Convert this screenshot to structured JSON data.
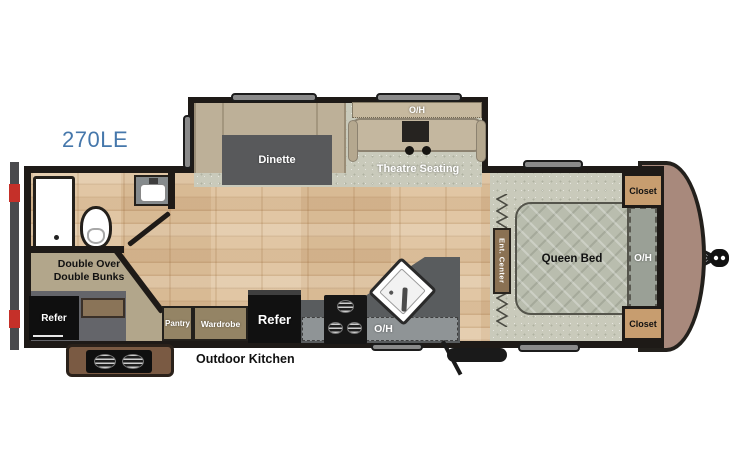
{
  "model": "270LE",
  "colors": {
    "model_text": "#4577ab",
    "wall": "#1e1a17",
    "wood_floor": "#dec19c",
    "carpet": "#c9cabb",
    "bench_tan": "#bdb098",
    "seat_tan": "#c4b79f",
    "table_gray": "#58595b",
    "counter_gray": "#595c5e",
    "overhead_gray": "#8f9496",
    "cabinet_brown": "#948465",
    "closet_tan": "#c79d6f",
    "ent_center_brown": "#8a7153",
    "bed_gray": "#b9bdae",
    "bunk_tan": "#b2a68b",
    "front_cap_brown": "#a8897c",
    "compartment_gray": "#64656a",
    "outdoor_kitchen_brown": "#7a5a43",
    "accent_red": "#c53029",
    "appliance_black": "#111111"
  },
  "labels": {
    "dinette": "Dinette",
    "theatre_seating": "Theatre Seating",
    "theatre_oh": "O/H",
    "queen_bed": "Queen Bed",
    "closet_top": "Closet",
    "closet_bottom": "Closet",
    "bedroom_oh": "O/H",
    "ent_center": "Ent. Center",
    "bunks_line1": "Double Over",
    "bunks_line2": "Double Bunks",
    "refer_outdoor": "Refer",
    "refer_main": "Refer",
    "pantry": "Pantry",
    "wardrobe": "Wardrobe",
    "kitchen_oh": "O/H",
    "outdoor_kitchen": "Outdoor Kitchen"
  }
}
